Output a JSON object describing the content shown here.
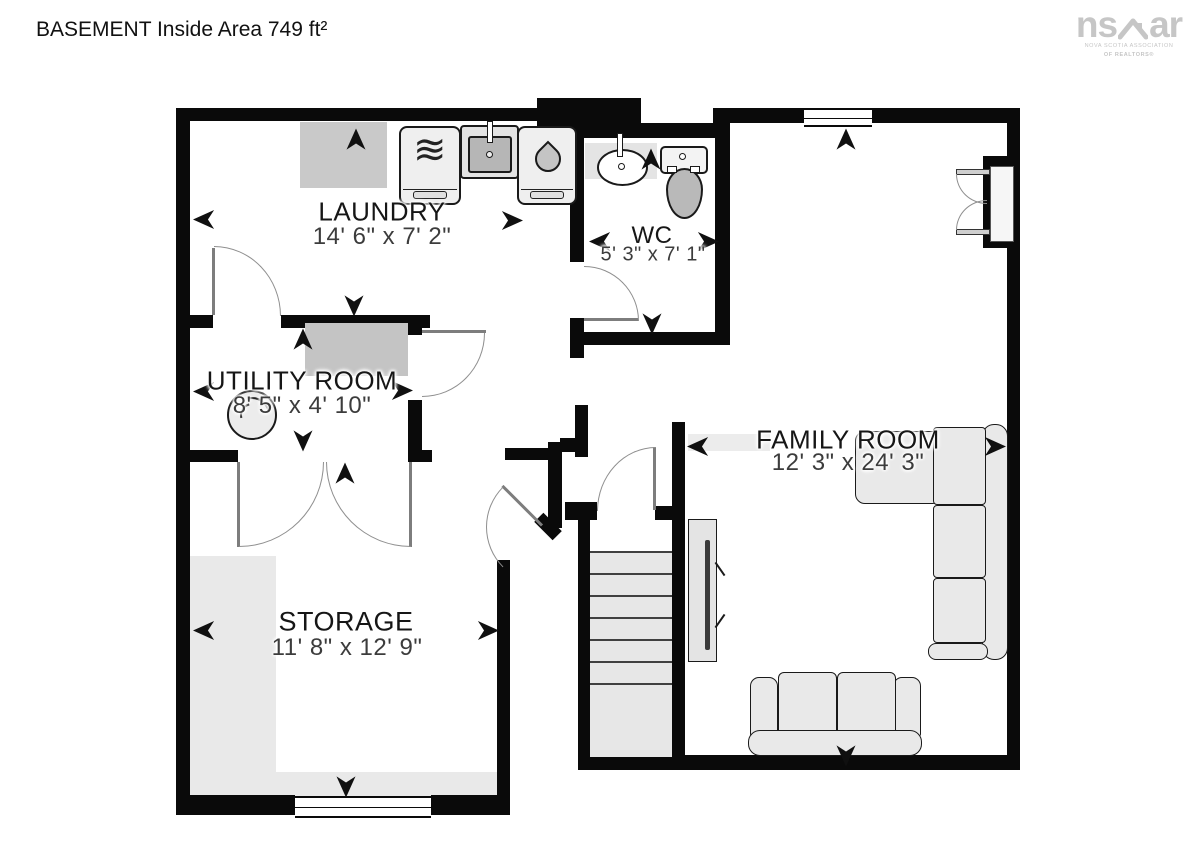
{
  "page": {
    "title": "BASEMENT Inside Area 749 ft²"
  },
  "logo": {
    "left": "ns",
    "right": "ar",
    "caption1": "NOVA SCOTIA ASSOCIATION",
    "caption2": "OF REALTORS®"
  },
  "rooms": {
    "laundry": {
      "name": "LAUNDRY",
      "dims": "14' 6\" x 7' 2\""
    },
    "wc": {
      "name": "WC",
      "dims": "5' 3\" x 7' 1\""
    },
    "utility": {
      "name": "UTILITY ROOM",
      "dims": "8' 5\" x 4' 10\""
    },
    "storage": {
      "name": "STORAGE",
      "dims": "11' 8\" x 12' 9\""
    },
    "family": {
      "name": "FAMILY ROOM",
      "dims": "12' 3\" x 24' 3\""
    }
  },
  "icons": {
    "washer": "washer-wave-icon",
    "dryer": "dryer-drop-icon",
    "laundry_sink": "laundry-sink-icon",
    "wc_sink": "oval-sink-icon",
    "toilet": "toilet-icon",
    "water_heater": "water-heater-icon",
    "furnace": "furnace-pad-icon",
    "tv": "wall-tv-icon",
    "arrows": "direction-chevron-icon"
  },
  "colors": {
    "wall": "#0a0a0a",
    "fixture_gray": "#c9c9c9",
    "floor_gray": "#e9e9e9",
    "logo_gray": "#c6c6c6"
  }
}
